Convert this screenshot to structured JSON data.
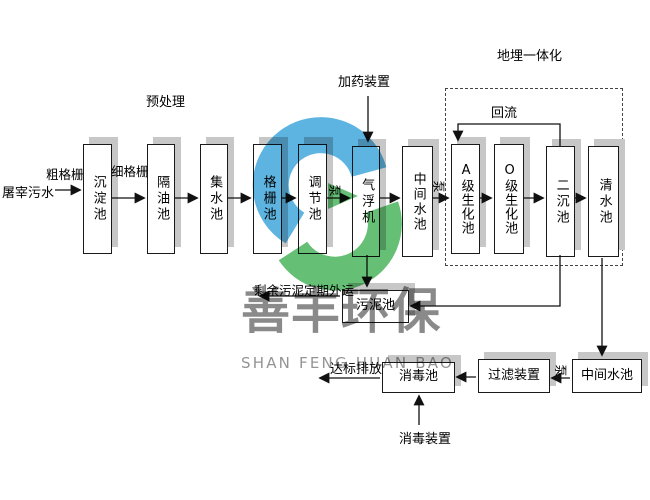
{
  "diagram_labels": {
    "influent": "屠宰污水",
    "coarse_screen": "粗格栅",
    "fine_screen": "细格栅",
    "pretreatment": "预处理",
    "dosing_device": "加药装置",
    "buried_integration": "地埋一体化",
    "reflux": "回流",
    "pump": "泵",
    "sludge_out": "剩余污泥定期外运",
    "discharge": "达标排放",
    "disinfection_device": "消毒装置"
  },
  "tanks": {
    "row1": [
      "沉淀池",
      "隔油池",
      "集水池",
      "格栅池",
      "调节池",
      "气浮机",
      "中间水池",
      "A级生化池",
      "O级生化池",
      "二沉池",
      "清水池"
    ],
    "sludge_tank": "污泥池",
    "bottom_row": [
      "中间水池",
      "过滤装置",
      "消毒池"
    ]
  },
  "watermark": {
    "name_cn": "善丰环保",
    "name_en": "SHAN FENG HUAN BAO",
    "logo_blue": "#41a7dc",
    "logo_green": "#4bb45c"
  }
}
